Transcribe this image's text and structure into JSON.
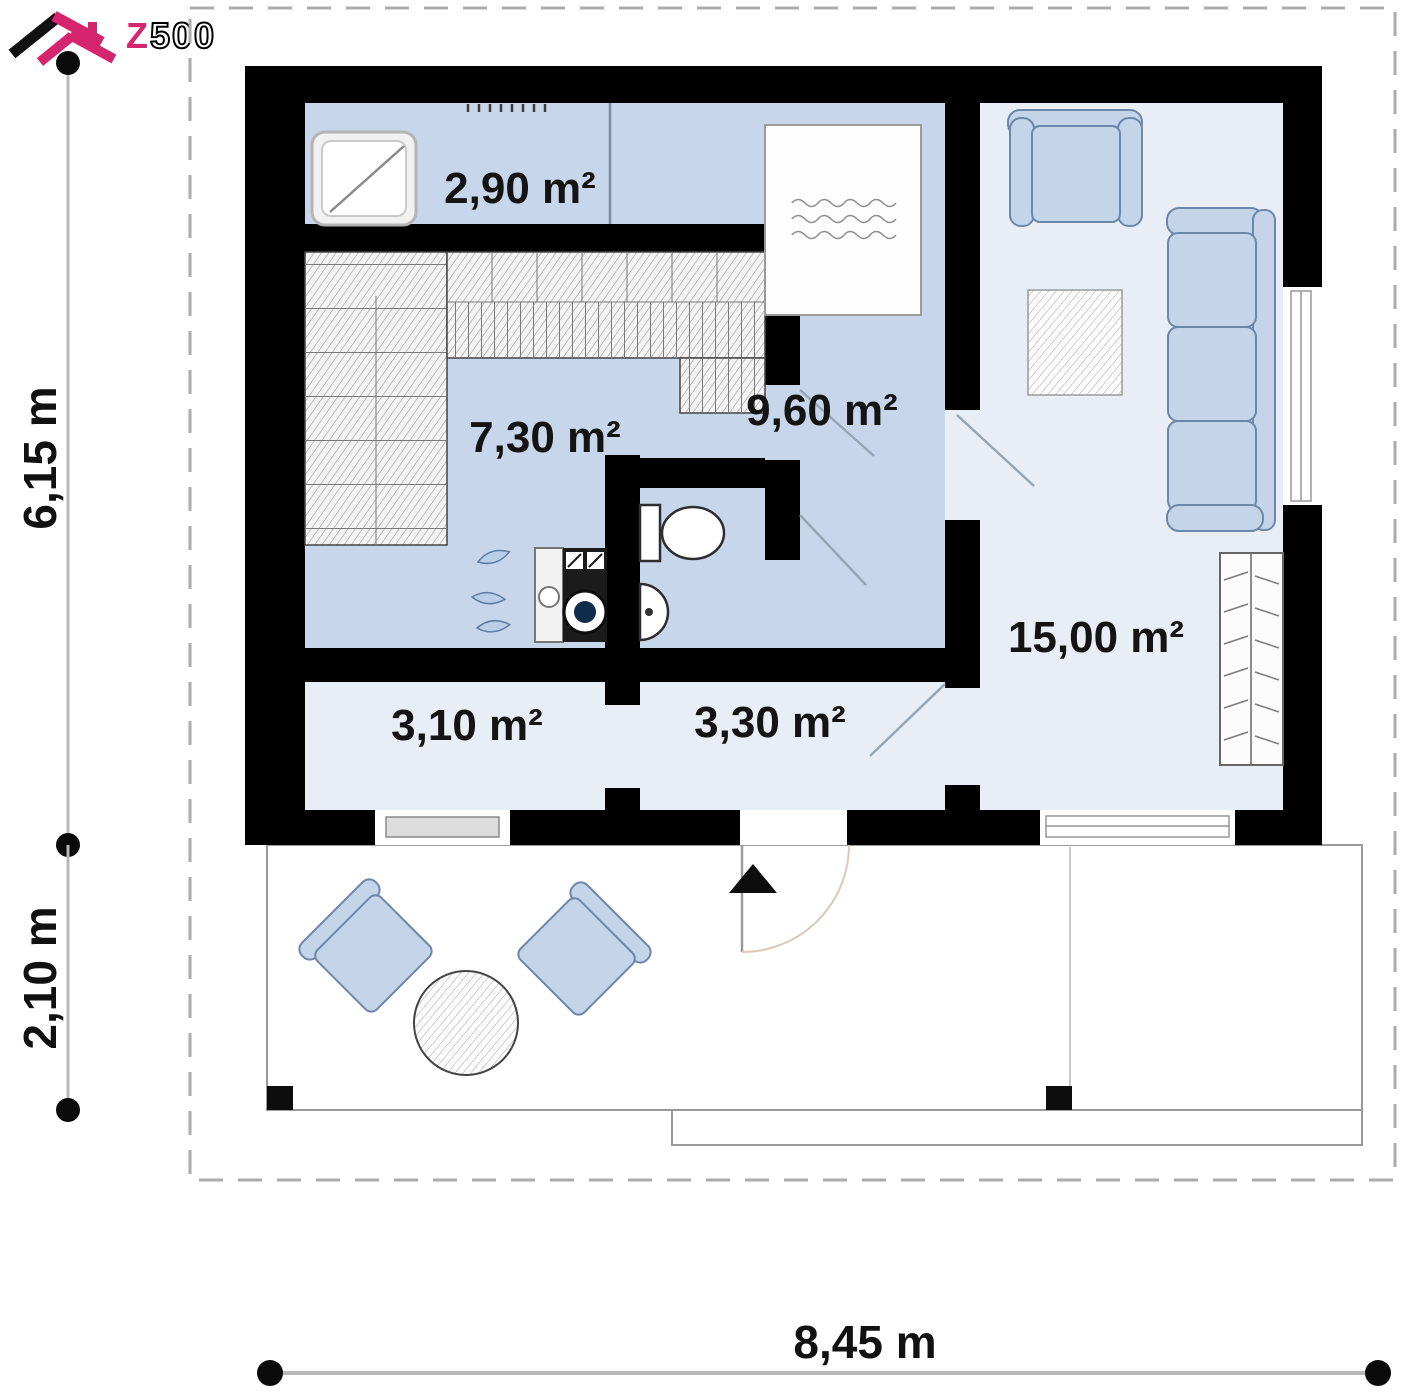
{
  "logo": {
    "text_accent": "Z",
    "text_rest": "500"
  },
  "dimensions": {
    "left_upper": "6,15 m",
    "left_lower": "2,10 m",
    "bottom": "8,45 m"
  },
  "rooms": [
    {
      "name": "shower-room",
      "area": "2,90 m²"
    },
    {
      "name": "sauna",
      "area": "7,30 m²"
    },
    {
      "name": "bedroom",
      "area": "9,60 m²"
    },
    {
      "name": "living-room",
      "area": "15,00 m²"
    },
    {
      "name": "hall",
      "area": "3,10 m²"
    },
    {
      "name": "entry-hall",
      "area": "3,30 m²"
    }
  ],
  "colors": {
    "wall": "#000000",
    "floor_blue": "#c7d6eb",
    "floor_light": "#e9eef6",
    "furniture_fill": "#c4d5ea",
    "furniture_stroke": "#6d87a8",
    "logo_pink": "#d6256f",
    "dashed_boundary": "#ababab",
    "dimension_line": "#b9b9b9"
  }
}
